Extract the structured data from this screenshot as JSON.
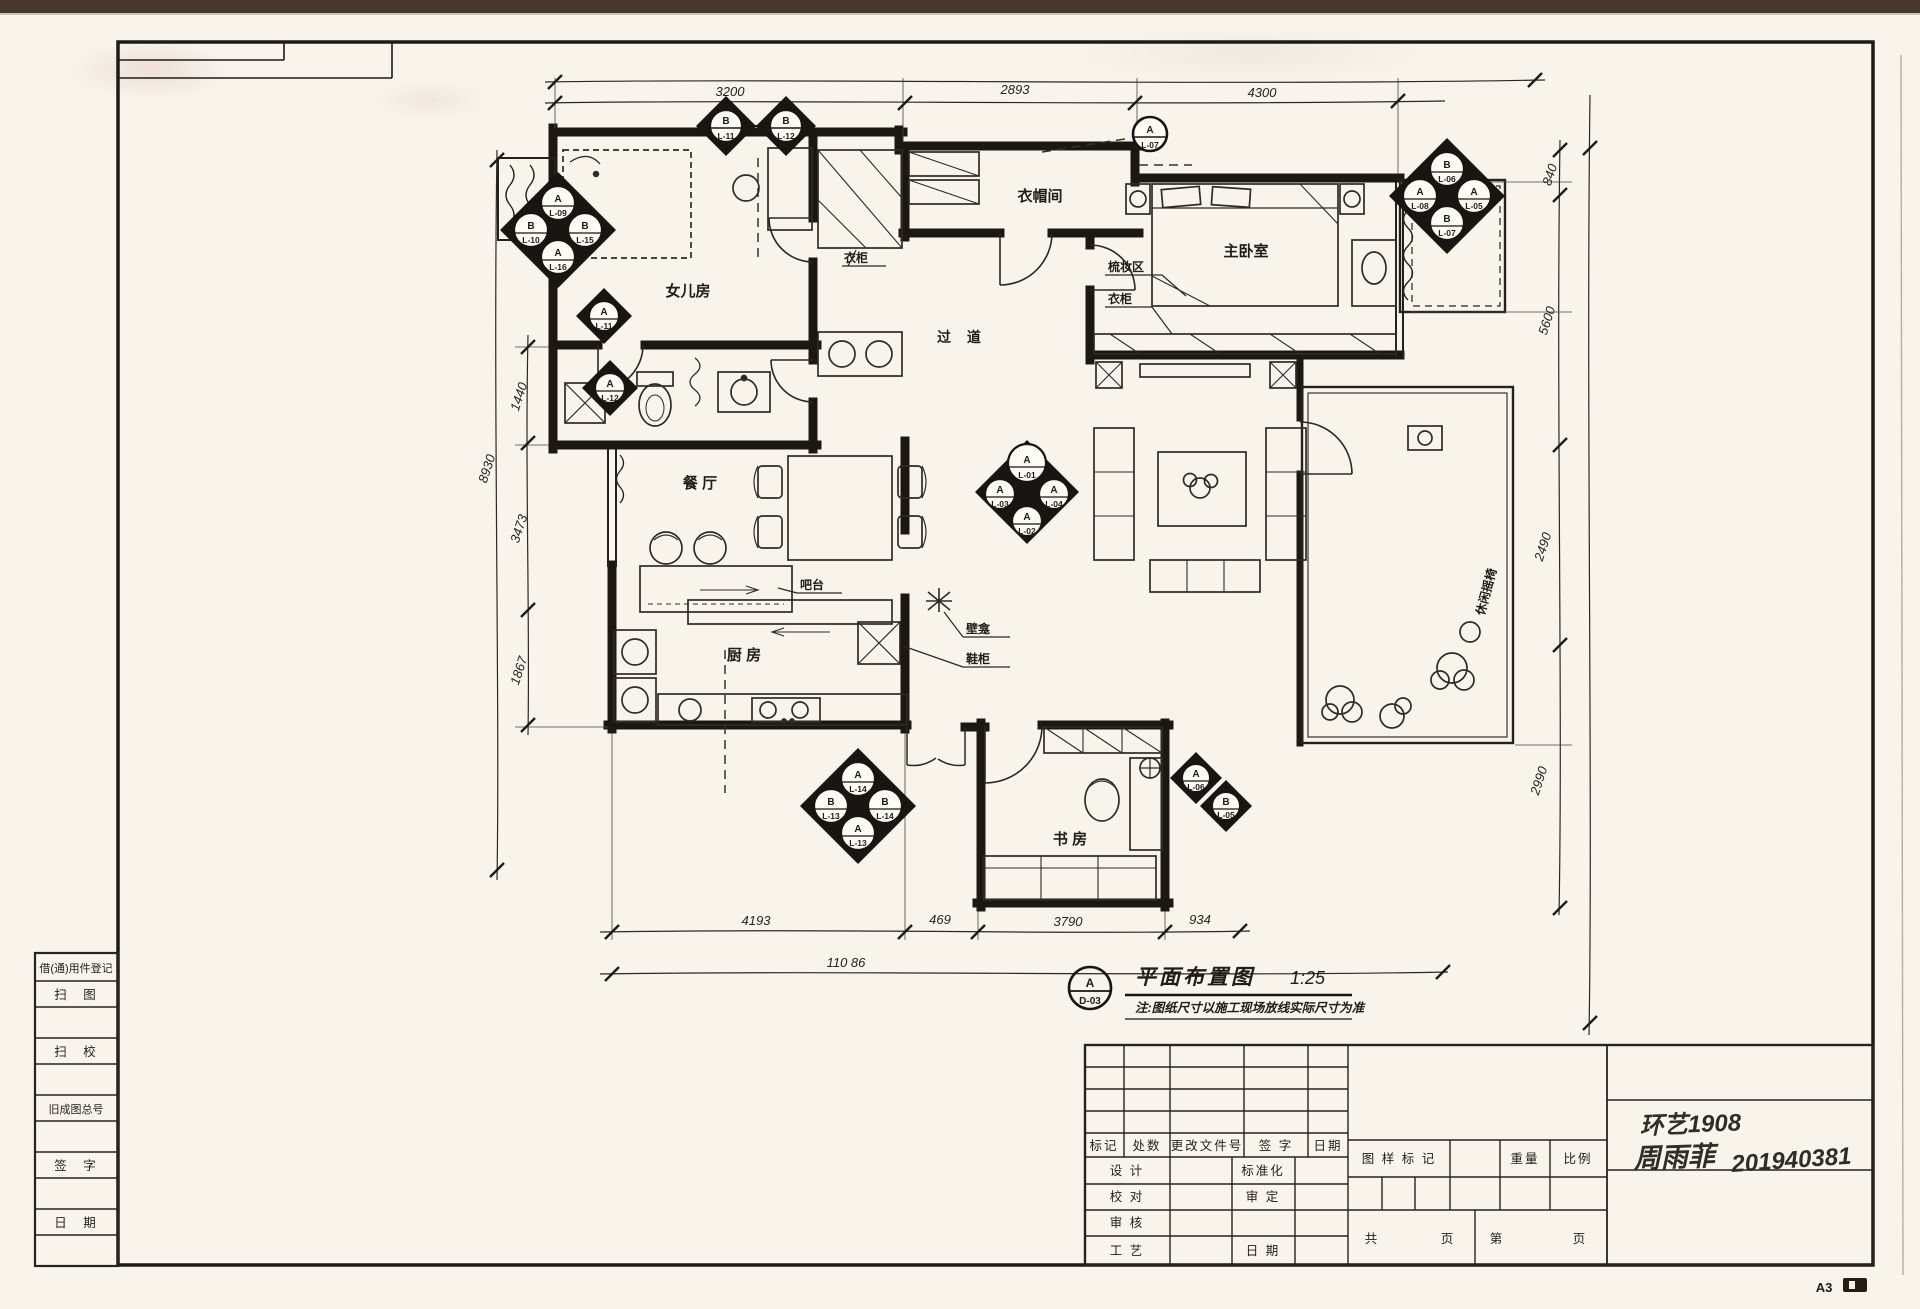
{
  "sheet": {
    "size": "A3"
  },
  "title": {
    "marker_letter": "A",
    "marker_code": "D-03",
    "text": "平面布置图",
    "scale": "1:25",
    "note": "注:图纸尺寸以施工现场放线实际尺寸为准"
  },
  "stamp": {
    "class_line": "环艺1908",
    "name": "周雨菲",
    "student_id": "201940381"
  },
  "left_table": {
    "r0": "借(通)用件登记",
    "r1": "扫　图",
    "r2": "扫　校",
    "r3": "旧成图总号",
    "r4": "签　字",
    "r5": "日　期"
  },
  "title_block": {
    "mark": "标记",
    "count": "处数",
    "doc": "更改文件号",
    "sign": "签 字",
    "date": "日期",
    "design": "设 计",
    "proof": "校 对",
    "review": "审 核",
    "craft": "工 艺",
    "std": "标准化",
    "approve": "审 定",
    "date2": "日 期",
    "stamp_mark": "图 样 标 记",
    "weight": "重量",
    "scale": "比例",
    "total": "共",
    "page": "页",
    "no": "第",
    "page2": "页"
  },
  "rooms": {
    "daughter": "女儿房",
    "cloak": "衣帽间",
    "hall": "过 道",
    "master": "主卧室",
    "dining": "餐 厅",
    "kitchen": "厨 房",
    "study": "书 房"
  },
  "anno": {
    "wardrobe1": "衣柜",
    "wardrobe2": "衣柜",
    "dresser": "梳妆区",
    "bar": "吧台",
    "niche": "壁龛",
    "shoe": "鞋柜",
    "balcony_chair": "休闲摇椅"
  },
  "dims": {
    "top": [
      "3200",
      "2893",
      "4300"
    ],
    "left": [
      "1440",
      "3473",
      "1867"
    ],
    "left_total": "8930",
    "right": [
      "840",
      "5600",
      "2490",
      "2990"
    ],
    "bottom": [
      "4193",
      "469",
      "3790",
      "934"
    ],
    "bottom_total": "110 86"
  },
  "markers": {
    "m1a": {
      "l": "B",
      "c": "L-11"
    },
    "m1b": {
      "l": "B",
      "c": "L-12"
    },
    "m2": {
      "l": "A",
      "c": "L-07"
    },
    "m3": {
      "n": {
        "l": "B",
        "c": "L-06"
      },
      "w": {
        "l": "A",
        "c": "L-08"
      },
      "e": {
        "l": "A",
        "c": "L-05"
      },
      "s": {
        "l": "B",
        "c": "L-07"
      }
    },
    "m4": {
      "n": {
        "l": "A",
        "c": "L-09"
      },
      "w": {
        "l": "B",
        "c": "L-10"
      },
      "e": {
        "l": "B",
        "c": "L-15"
      },
      "s": {
        "l": "A",
        "c": "L-16"
      }
    },
    "m5": {
      "l": "A",
      "c": "L-11"
    },
    "m6": {
      "l": "A",
      "c": "L-12"
    },
    "m7": {
      "n": {
        "l": "A",
        "c": "L-01"
      },
      "w": {
        "l": "A",
        "c": "L-03"
      },
      "e": {
        "l": "A",
        "c": "L-04"
      },
      "s": {
        "l": "A",
        "c": "L-02"
      }
    },
    "m8": {
      "n": {
        "l": "A",
        "c": "L-14"
      },
      "w": {
        "l": "B",
        "c": "L-13"
      },
      "e": {
        "l": "B",
        "c": "L-14"
      },
      "s": {
        "l": "A",
        "c": "L-13"
      }
    },
    "m9a": {
      "l": "A",
      "c": "L-06"
    },
    "m9b": {
      "l": "B",
      "c": "L-05"
    }
  }
}
